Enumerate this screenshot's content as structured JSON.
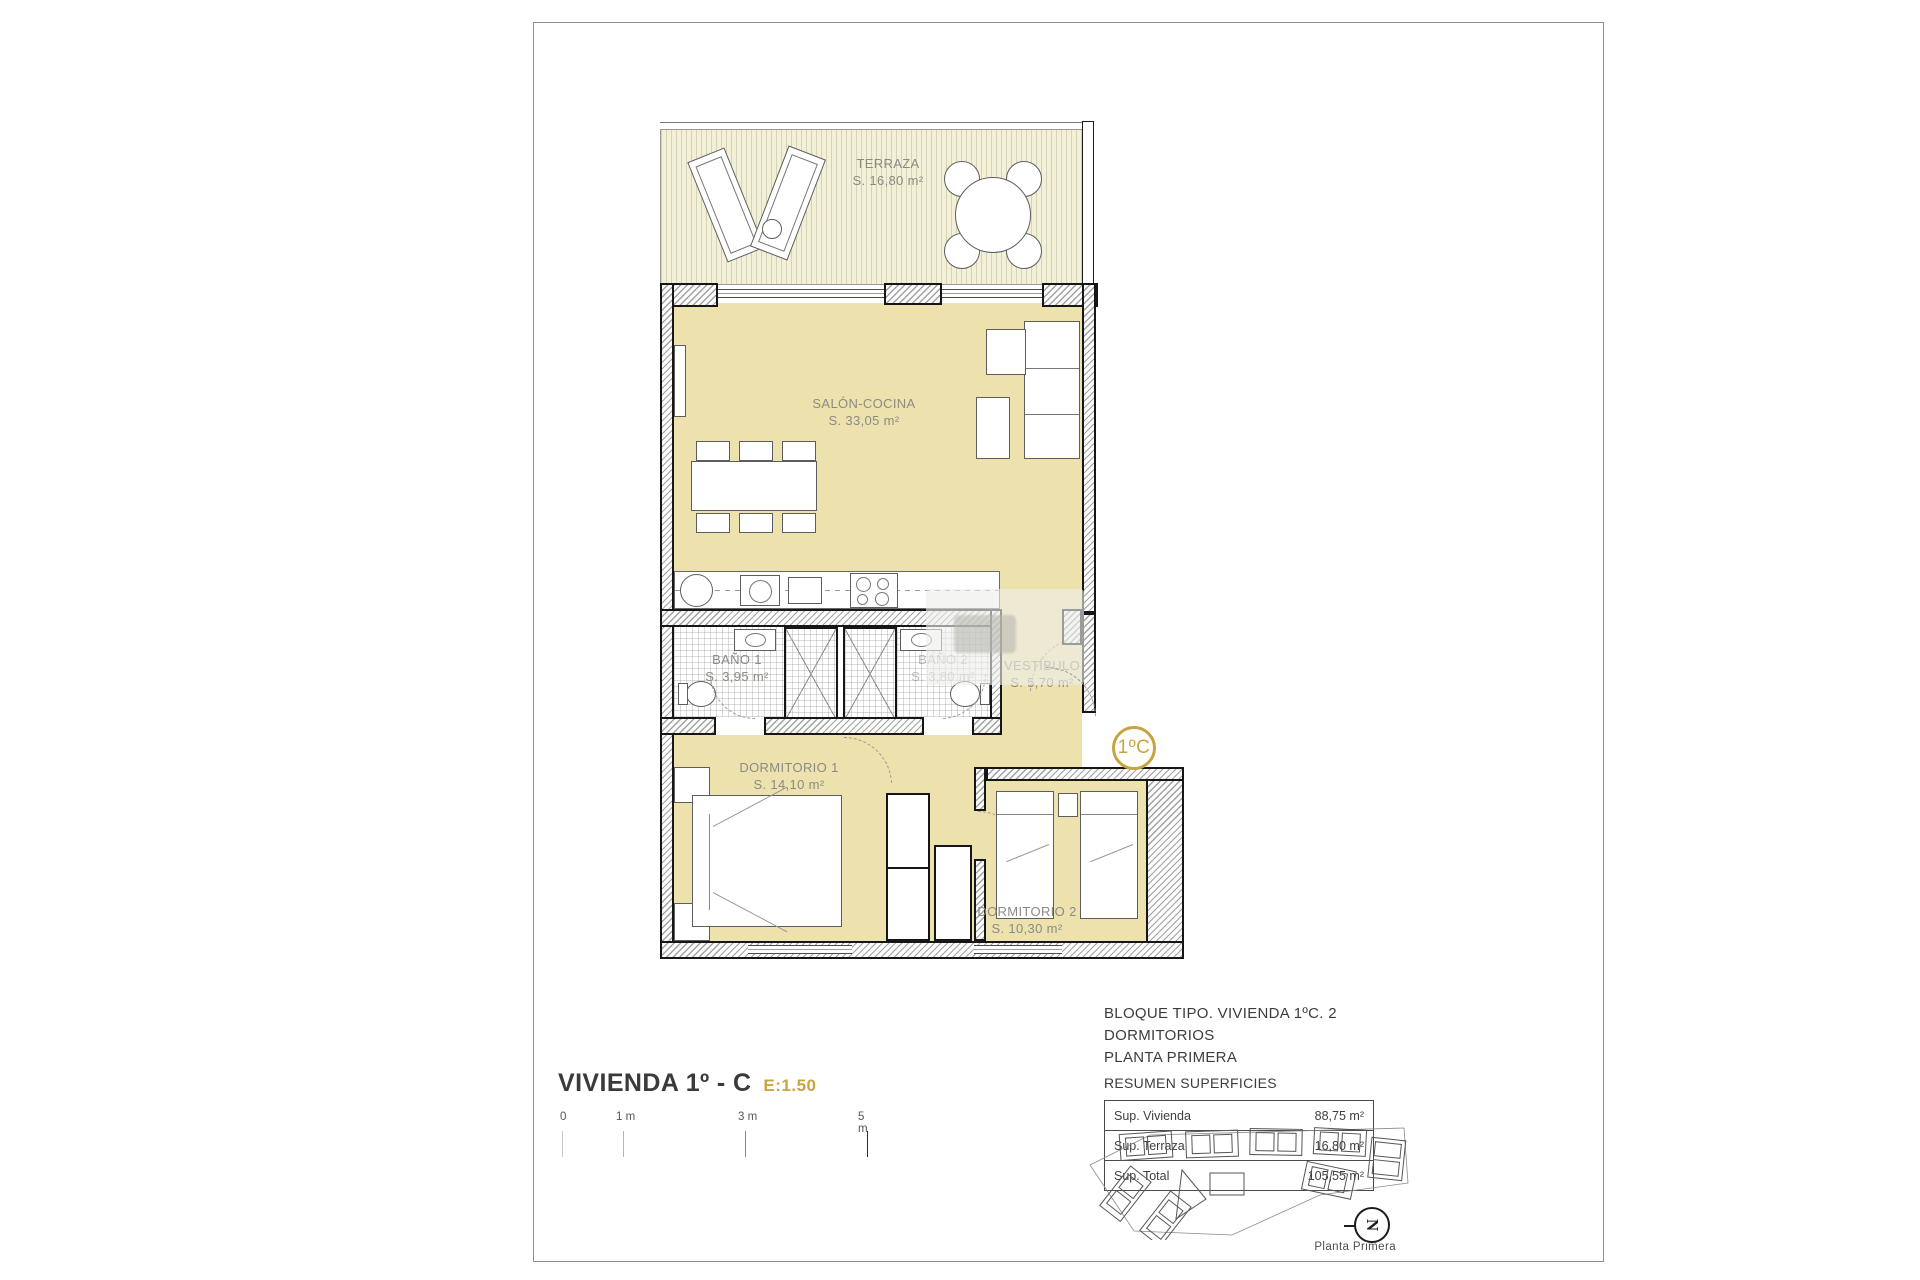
{
  "colors": {
    "accent": "#C8A440",
    "floor": "#EDE2AE",
    "terrace": "#F4F0D8",
    "wall_line": "#161616"
  },
  "plan": {
    "unit_badge": "1ºC",
    "rooms": {
      "terraza": {
        "name": "TERRAZA",
        "area": "S. 16,80 m²"
      },
      "salon": {
        "name": "SALÓN-COCINA",
        "area": "S. 33,05 m²"
      },
      "bano1": {
        "name": "BAÑO 1",
        "area": "S. 3,95 m²"
      },
      "bano2": {
        "name": "BAÑO 2",
        "area": "S. 3,80 m²"
      },
      "vestibulo": {
        "name": "VESTÍBULO",
        "area": "S. 5,70 m²"
      },
      "dormitorio1": {
        "name": "DORMITORIO 1",
        "area": "S. 14,10 m²"
      },
      "dormitorio2": {
        "name": "DORMITORIO 2",
        "area": "S. 10,30 m²"
      }
    }
  },
  "title_block": {
    "title": "VIVIENDA 1º - C",
    "scale": "E:1.50",
    "scale_bar": [
      "0",
      "1 m",
      "3 m",
      "5 m"
    ]
  },
  "summary": {
    "block_line1": "BLOQUE TIPO. VIVIENDA 1ºC. 2 DORMITORIOS",
    "block_line2": "PLANTA PRIMERA",
    "block_line3": "RESUMEN SUPERFICIES",
    "rows": [
      {
        "label": "Sup. Vivienda",
        "value": "88,75 m²"
      },
      {
        "label": "Sup. Terraza",
        "value": "16,80 m²"
      },
      {
        "label": "Sup. Total",
        "value": "105,55 m²"
      }
    ]
  },
  "keyplan": {
    "caption": "Planta Primera",
    "north": "N"
  }
}
